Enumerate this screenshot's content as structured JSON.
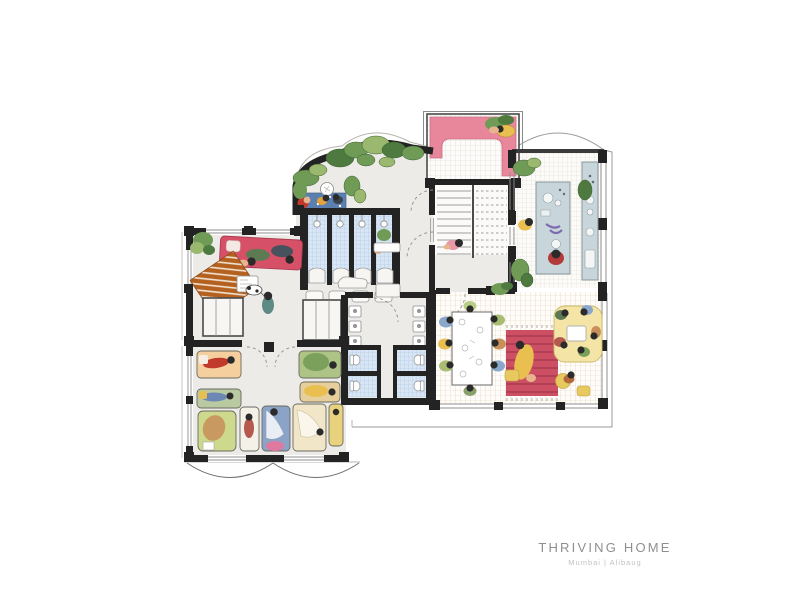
{
  "title_block": {
    "title": "THRIVING HOME",
    "subtitle": "Mumbai | Alibaug"
  },
  "palette": {
    "wall": "#232323",
    "floor": "#ecebe7",
    "stair_floor": "#fbfaf8",
    "sketch_line": "#9a9a9a",
    "tile_blue": "#d7e5f4",
    "tile_blue_grid": "#aec6e2",
    "tile_white_grid": "#d9d6cf",
    "kitchen_grid": "#dcdcd4",
    "dining_grid": "#e2cdb8",
    "pink_bench": "#e8879b",
    "red_sofa": "#d65068",
    "rug_rust": "#b4611f",
    "garden_rug_blue": "#5b7fae",
    "rug_red": "#cc4f63",
    "rug_red_stripe": "#a83c50",
    "sofa_yellow": "#f4e5a7",
    "counter_blue": "#c8d5da",
    "plant_dark": "#4e7a3f",
    "plant_mid": "#6f9b57",
    "plant_light": "#9ab86e",
    "skin": "#e8b48c",
    "hair": "#2b2b2b",
    "title_text": "#8f8f8f",
    "subtitle_text": "#c2c2c2"
  },
  "regions": [
    {
      "name": "garden-terrace"
    },
    {
      "name": "shower-block"
    },
    {
      "name": "pink-roof-terrace"
    },
    {
      "name": "staircase"
    },
    {
      "name": "kitchen"
    },
    {
      "name": "lounge"
    },
    {
      "name": "hallway"
    },
    {
      "name": "washroom"
    },
    {
      "name": "dormitory"
    },
    {
      "name": "dining-living-room"
    }
  ],
  "fixtures": {
    "shower_stalls": 4,
    "wc_stalls": 4,
    "wash_basins": 6,
    "beds": 9
  },
  "beds": [
    {
      "color": "#f6cf9e"
    },
    {
      "color": "#b9c9a2"
    },
    {
      "color": "#cdd98c"
    },
    {
      "color": "#f4f1e8"
    },
    {
      "color": "#8aa3c6"
    },
    {
      "color": "#f1e7c8"
    },
    {
      "color": "#e8d27e"
    },
    {
      "color": "#aec487"
    },
    {
      "color": "#e6cf9a"
    }
  ]
}
